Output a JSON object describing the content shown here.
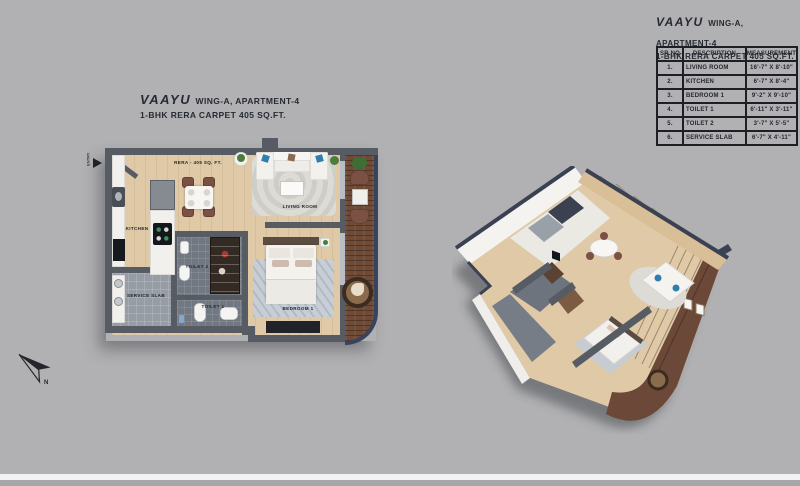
{
  "page": {
    "background": "#b1b1b3"
  },
  "plan_header": {
    "brand": "VAAYU",
    "wing": "WING-A, APARTMENT-4",
    "carpet": "1-BHK RERA CARPET 405 SQ.FT."
  },
  "table_header": {
    "brand": "VAAYU",
    "wing": "WING-A, APARTMENT-4",
    "carpet": "1-BHK RERA CARPET 405 SQ.FT."
  },
  "area_table": {
    "columns": [
      "SR.NO",
      "DESCRIPTION",
      "MEASUREMENT"
    ],
    "rows": [
      {
        "sr": "1.",
        "desc": "LIVING ROOM",
        "meas": "16'-7\" X 8'-10\""
      },
      {
        "sr": "2.",
        "desc": "KITCHEN",
        "meas": "6'-7\" X 8'-4\""
      },
      {
        "sr": "3.",
        "desc": "BEDROOM 1",
        "meas": "9'-2\" X 9'-10\""
      },
      {
        "sr": "4.",
        "desc": "TOILET 1",
        "meas": "6'-11\" X 3'-11\""
      },
      {
        "sr": "5.",
        "desc": "TOILET 2",
        "meas": "3'-7\" X 5'-5\""
      },
      {
        "sr": "6.",
        "desc": "SERVICE SLAB",
        "meas": "6'-7\" X 4'-11\""
      }
    ]
  },
  "floor_plan": {
    "rera_label": "RERA - 405 SQ. FT.",
    "entry_label": "ENTRY",
    "rooms": {
      "kitchen": "KITCHEN",
      "living_room": "LIVING ROOM",
      "bedroom": "BEDROOM 1",
      "toilet1": "TOILET 1",
      "toilet2": "TOILET 2",
      "service_slab": "SERVICE SLAB"
    }
  },
  "compass": {
    "north_label": "N"
  },
  "colors": {
    "wall_gray": "#575b64",
    "navy_edge": "#39445c",
    "wood_floor": "#dfc9a6",
    "balcony_wood": "#6f4b37",
    "toilet_tile": "#717881",
    "service_tile": "#979da5",
    "marble_counter": "#f1f0ed",
    "text_dark": "#262a32",
    "pillow_blue": "#2f7fae"
  }
}
